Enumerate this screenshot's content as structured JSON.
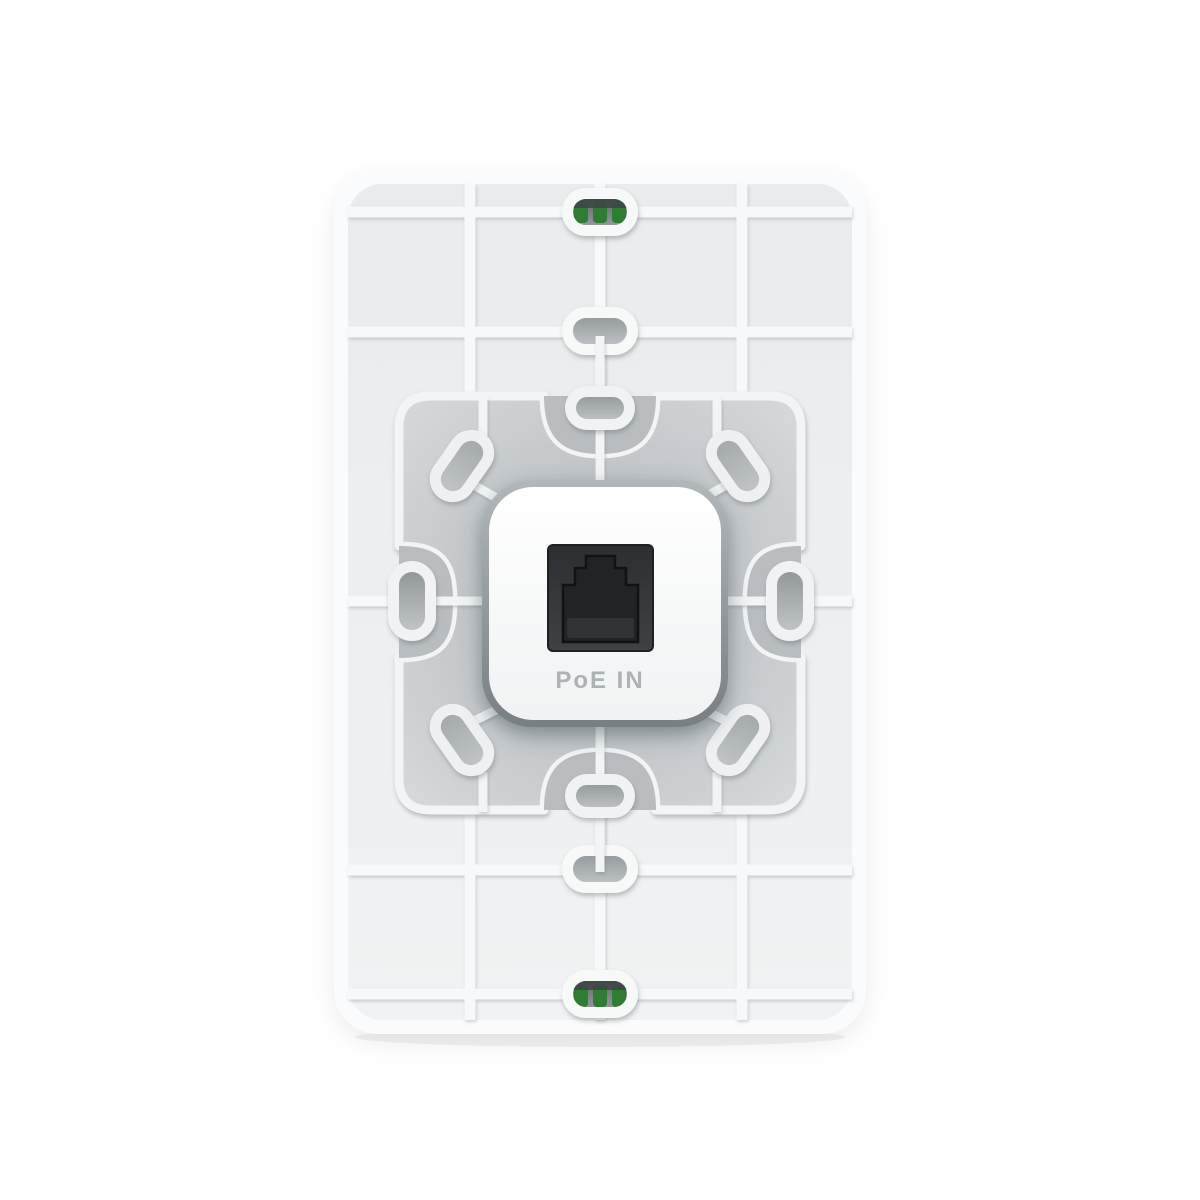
{
  "device": {
    "port_label": "PoE IN",
    "colors": {
      "background": "#ffffff",
      "plate_rim": "#fafbfc",
      "panel": "#edeff1",
      "rib": "#f7f8f9",
      "plateau_center": "#b6babd",
      "plateau_edge": "#d8dbdd",
      "notch_pocket": "#b9bdc0",
      "module_ring_top": "#aeb3b6",
      "module_ring_bottom": "#7c8184",
      "module_face": "#fdfefe",
      "rj45_recess": "#35383a",
      "rj45_jack": "#212425",
      "terminal_contact_green": "#2f7d33",
      "label_text": "#adb2b5"
    }
  }
}
